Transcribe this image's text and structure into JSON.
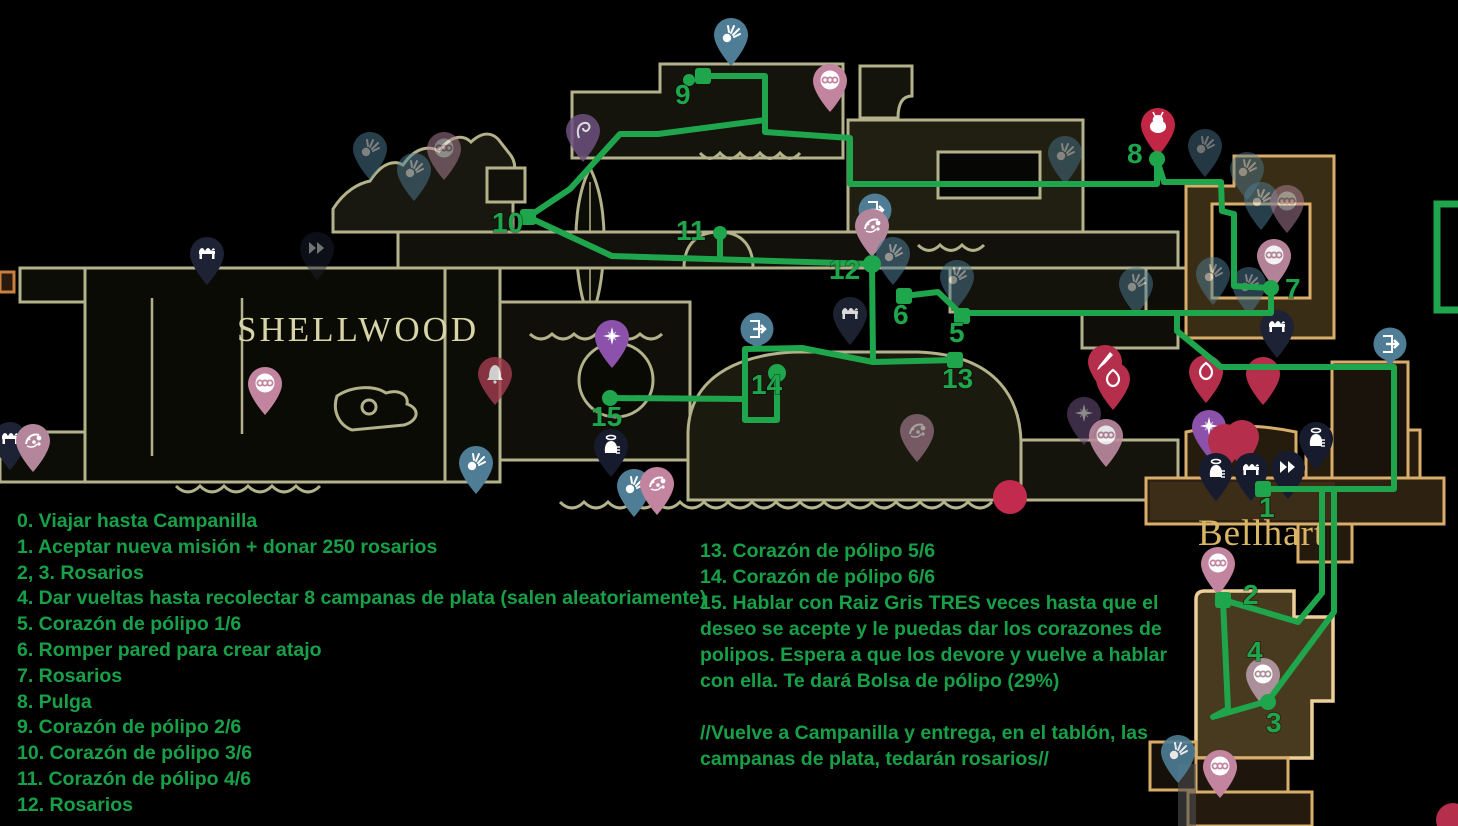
{
  "colors": {
    "background": "#000000",
    "route_green": "#1fa64c",
    "text_green": "#18a048",
    "shellwood_outline": "#b4b28a",
    "bellhart_outline": "#d9ae6b",
    "pin_teal": "#4e7d95",
    "pin_pink": "#c2849f",
    "pin_mauve": "#b3869c",
    "pin_red": "#b52e4c",
    "pin_navy": "#1d2235",
    "pin_purple": "#8c51ab"
  },
  "region_labels": [
    {
      "text": "SHELLWOOD"
    },
    {
      "text": "Bellhart"
    }
  ],
  "guide": {
    "left_steps": [
      "0. Viajar hasta Campanilla",
      "1. Aceptar nueva misión + donar 250 rosarios",
      "2, 3. Rosarios",
      "4. Dar vueltas hasta recolectar 8 campanas de plata (salen aleatoriamente)",
      "5. Corazón de pólipo 1/6",
      "6. Romper pared para crear atajo",
      "7. Rosarios",
      "8. Pulga",
      "9. Corazón de pólipo 2/6",
      "10. Corazón de pólipo 3/6",
      "11. Corazón de pólipo 4/6",
      "12. Rosarios"
    ],
    "right_lines": [
      "13. Corazón de pólipo 5/6",
      "14. Corazón de pólipo 6/6",
      "15. Hablar con Raiz Gris TRES veces hasta que el",
      "deseo se acepte y le puedas dar los corazones de",
      "polipos. Espera a que los devore y vuelve a hablar",
      "con ella. Te dará Bolsa de pólipo (29%)",
      "",
      "//Vuelve a Campanilla y entrega, en el tablón, las",
      "campanas de plata, tedarán rosarios//"
    ]
  },
  "route": {
    "color": "#1fa64c",
    "polylines": [
      [
        [
          703,
          76
        ],
        [
          765,
          76
        ],
        [
          765,
          132
        ],
        [
          850,
          138
        ],
        [
          850,
          184
        ],
        [
          1157,
          184
        ],
        [
          1157,
          160
        ]
      ],
      [
        [
          1157,
          160
        ],
        [
          1164,
          182
        ],
        [
          1221,
          182
        ],
        [
          1222,
          211
        ],
        [
          1234,
          214
        ],
        [
          1234,
          286
        ],
        [
          1271,
          288
        ]
      ],
      [
        [
          1271,
          288
        ],
        [
          1271,
          313
        ],
        [
          962,
          313
        ],
        [
          962,
          315
        ]
      ],
      [
        [
          962,
          315
        ],
        [
          938,
          292
        ],
        [
          904,
          296
        ]
      ],
      [
        [
          1177,
          313
        ],
        [
          1177,
          331
        ],
        [
          1221,
          367
        ],
        [
          1394,
          367
        ],
        [
          1394,
          489
        ],
        [
          1263,
          489
        ]
      ],
      [
        [
          1322,
          489
        ],
        [
          1322,
          593
        ],
        [
          1298,
          622
        ],
        [
          1227,
          601
        ]
      ],
      [
        [
          1334,
          489
        ],
        [
          1334,
          612
        ],
        [
          1268,
          701
        ]
      ],
      [
        [
          1223,
          601
        ],
        [
          1228,
          709
        ],
        [
          1213,
          717
        ]
      ],
      [
        [
          1268,
          701
        ],
        [
          1216,
          716
        ]
      ],
      [
        [
          528,
          217
        ],
        [
          570,
          189
        ],
        [
          620,
          134
        ],
        [
          658,
          134
        ],
        [
          765,
          120
        ]
      ],
      [
        [
          528,
          217
        ],
        [
          612,
          256
        ],
        [
          872,
          264
        ]
      ],
      [
        [
          720,
          234
        ],
        [
          720,
          259
        ]
      ],
      [
        [
          872,
          264
        ],
        [
          873,
          362
        ],
        [
          955,
          360
        ]
      ],
      [
        [
          873,
          362
        ],
        [
          802,
          348
        ],
        [
          745,
          349
        ],
        [
          745,
          420
        ],
        [
          777,
          420
        ],
        [
          777,
          374
        ]
      ],
      [
        [
          745,
          399
        ],
        [
          610,
          398
        ]
      ]
    ],
    "nodes": [
      {
        "x": 703,
        "y": 76,
        "s": "sq"
      },
      {
        "x": 689,
        "y": 80,
        "s": "dot",
        "r": 6
      },
      {
        "x": 528,
        "y": 217,
        "s": "sq"
      },
      {
        "x": 720,
        "y": 233,
        "s": "dot",
        "r": 7
      },
      {
        "x": 872,
        "y": 264,
        "s": "dot",
        "r": 9
      },
      {
        "x": 904,
        "y": 296,
        "s": "sq"
      },
      {
        "x": 962,
        "y": 316,
        "s": "sq"
      },
      {
        "x": 955,
        "y": 360,
        "s": "sq"
      },
      {
        "x": 777,
        "y": 373,
        "s": "dot",
        "r": 9
      },
      {
        "x": 610,
        "y": 398,
        "s": "dot",
        "r": 8
      },
      {
        "x": 1157,
        "y": 159,
        "s": "dot",
        "r": 8
      },
      {
        "x": 1271,
        "y": 288,
        "s": "dot",
        "r": 8
      },
      {
        "x": 1263,
        "y": 489,
        "s": "sq"
      },
      {
        "x": 1223,
        "y": 600,
        "s": "sq"
      },
      {
        "x": 1268,
        "y": 702,
        "s": "dot",
        "r": 8
      }
    ],
    "labels": [
      {
        "n": "1",
        "x": 1259,
        "y": 497
      },
      {
        "n": "2",
        "x": 1243,
        "y": 584
      },
      {
        "n": "3",
        "x": 1266,
        "y": 712
      },
      {
        "n": "4",
        "x": 1247,
        "y": 641
      },
      {
        "n": "5",
        "x": 949,
        "y": 322
      },
      {
        "n": "6",
        "x": 893,
        "y": 304
      },
      {
        "n": "7",
        "x": 1285,
        "y": 278
      },
      {
        "n": "8",
        "x": 1127,
        "y": 143
      },
      {
        "n": "9",
        "x": 675,
        "y": 84
      },
      {
        "n": "10",
        "x": 492,
        "y": 212
      },
      {
        "n": "11",
        "x": 676,
        "y": 220
      },
      {
        "n": "12",
        "x": 829,
        "y": 259
      },
      {
        "n": "13",
        "x": 942,
        "y": 368
      },
      {
        "n": "14",
        "x": 751,
        "y": 374
      },
      {
        "n": "15",
        "x": 591,
        "y": 406
      }
    ],
    "rect": {
      "x": 1437,
      "y": 204,
      "w": 30,
      "h": 106
    }
  },
  "pins": [
    {
      "x": 731,
      "y": 66,
      "icon": "burst",
      "color": "#4e7d95"
    },
    {
      "x": 830,
      "y": 112,
      "icon": "beads",
      "color": "#c2849f"
    },
    {
      "x": 583,
      "y": 162,
      "icon": "swirl",
      "color": "#6e5180",
      "opacity": 0.85
    },
    {
      "x": 370,
      "y": 180,
      "icon": "burst",
      "color": "#4e7d95",
      "opacity": 0.5
    },
    {
      "x": 414,
      "y": 201,
      "icon": "burst",
      "color": "#4e7d95",
      "opacity": 0.5
    },
    {
      "x": 444,
      "y": 180,
      "icon": "beads",
      "color": "#b3869c",
      "opacity": 0.5
    },
    {
      "x": 1065,
      "y": 184,
      "icon": "burst",
      "color": "#4e7d95",
      "opacity": 0.45
    },
    {
      "x": 1158,
      "y": 156,
      "icon": "flea",
      "color": "#c22645"
    },
    {
      "x": 1205,
      "y": 177,
      "icon": "burst",
      "color": "#4e7d95",
      "opacity": 0.45
    },
    {
      "x": 1247,
      "y": 200,
      "icon": "burst",
      "color": "#4e7d95",
      "opacity": 0.45
    },
    {
      "x": 1261,
      "y": 230,
      "icon": "burst",
      "color": "#4e7d95",
      "opacity": 0.5
    },
    {
      "x": 1287,
      "y": 233,
      "icon": "beads",
      "color": "#b3869c",
      "opacity": 0.5
    },
    {
      "x": 1274,
      "y": 287,
      "icon": "beads",
      "color": "#bd8aa0",
      "opacity": 0.95
    },
    {
      "x": 1213,
      "y": 305,
      "icon": "burst",
      "color": "#4e7d95",
      "opacity": 0.5
    },
    {
      "x": 1249,
      "y": 315,
      "icon": "burst",
      "color": "#4e7d95",
      "opacity": 0.5
    },
    {
      "x": 1136,
      "y": 315,
      "icon": "burst",
      "color": "#4e7d95",
      "opacity": 0.5
    },
    {
      "x": 207,
      "y": 285,
      "icon": "bench",
      "color": "#1d2235"
    },
    {
      "x": 317,
      "y": 280,
      "icon": "fast-travel",
      "color": "#1d2235",
      "opacity": 0.45
    },
    {
      "x": 875,
      "y": 233,
      "icon": "door",
      "color": "#4e7d95",
      "shape": "circle"
    },
    {
      "x": 872,
      "y": 257,
      "icon": "polyp",
      "color": "#b3869c"
    },
    {
      "x": 893,
      "y": 285,
      "icon": "burst",
      "color": "#4e7d95",
      "opacity": 0.55
    },
    {
      "x": 957,
      "y": 308,
      "icon": "burst",
      "color": "#4e7d95",
      "opacity": 0.5
    },
    {
      "x": 850,
      "y": 345,
      "icon": "bench",
      "color": "#23283c",
      "opacity": 0.85
    },
    {
      "x": 757,
      "y": 352,
      "icon": "door",
      "color": "#4e7d95",
      "shape": "circle"
    },
    {
      "x": 612,
      "y": 368,
      "icon": "star",
      "color": "#8c51ab"
    },
    {
      "x": 495,
      "y": 405,
      "icon": "bell",
      "color": "#a33c50",
      "opacity": 0.8
    },
    {
      "x": 265,
      "y": 415,
      "icon": "beads",
      "color": "#c2849f"
    },
    {
      "x": 10,
      "y": 470,
      "icon": "bench",
      "color": "#1d2235"
    },
    {
      "x": 33,
      "y": 472,
      "icon": "polyp",
      "color": "#b3869c"
    },
    {
      "x": 611,
      "y": 477,
      "icon": "npc",
      "color": "#161b2e"
    },
    {
      "x": 476,
      "y": 494,
      "icon": "burst",
      "color": "#4e7d95"
    },
    {
      "x": 634,
      "y": 517,
      "icon": "burst",
      "color": "#4e7d95"
    },
    {
      "x": 657,
      "y": 515,
      "icon": "polyp",
      "color": "#c2849f"
    },
    {
      "x": 917,
      "y": 462,
      "icon": "polyp",
      "color": "#b3869c",
      "opacity": 0.6
    },
    {
      "x": 1010,
      "y": 497,
      "icon": "none",
      "color": "#c22b4d",
      "shape": "circle",
      "notail": true
    },
    {
      "x": 1105,
      "y": 393,
      "icon": "needle",
      "color": "#b52e4c"
    },
    {
      "x": 1113,
      "y": 410,
      "icon": "eye",
      "color": "#b52e4c"
    },
    {
      "x": 1206,
      "y": 403,
      "icon": "eye",
      "color": "#b52e4c"
    },
    {
      "x": 1263,
      "y": 405,
      "icon": "none",
      "color": "#b52e4c"
    },
    {
      "x": 1277,
      "y": 358,
      "icon": "bench",
      "color": "#1d2235"
    },
    {
      "x": 1084,
      "y": 445,
      "icon": "star",
      "color": "#6e5180",
      "opacity": 0.55
    },
    {
      "x": 1106,
      "y": 467,
      "icon": "beads",
      "color": "#bd8aa0",
      "opacity": 0.9
    },
    {
      "x": 1209,
      "y": 458,
      "icon": "star",
      "color": "#8c51ab"
    },
    {
      "x": 1225,
      "y": 472,
      "icon": "none",
      "color": "#b52e4c"
    },
    {
      "x": 1242,
      "y": 468,
      "icon": "none",
      "color": "#b52e4c"
    },
    {
      "x": 1216,
      "y": 501,
      "icon": "npc",
      "color": "#161b2e"
    },
    {
      "x": 1251,
      "y": 501,
      "icon": "bench",
      "color": "#161b2e"
    },
    {
      "x": 1288,
      "y": 499,
      "icon": "fast-travel",
      "color": "#161b2e"
    },
    {
      "x": 1316,
      "y": 470,
      "icon": "npc",
      "color": "#161b2e"
    },
    {
      "x": 1390,
      "y": 367,
      "icon": "door",
      "color": "#4e7d95",
      "shape": "circle"
    },
    {
      "x": 1218,
      "y": 595,
      "icon": "beads",
      "color": "#c2849f"
    },
    {
      "x": 1263,
      "y": 706,
      "icon": "beads",
      "color": "#ab8f99"
    },
    {
      "x": 1220,
      "y": 798,
      "icon": "beads",
      "color": "#c2849f"
    },
    {
      "x": 1178,
      "y": 783,
      "icon": "burst",
      "color": "#4e7d95",
      "opacity": 0.9
    },
    {
      "x": 1453,
      "y": 820,
      "icon": "none",
      "color": "#b52e4c",
      "shape": "circle",
      "notail": true
    }
  ]
}
